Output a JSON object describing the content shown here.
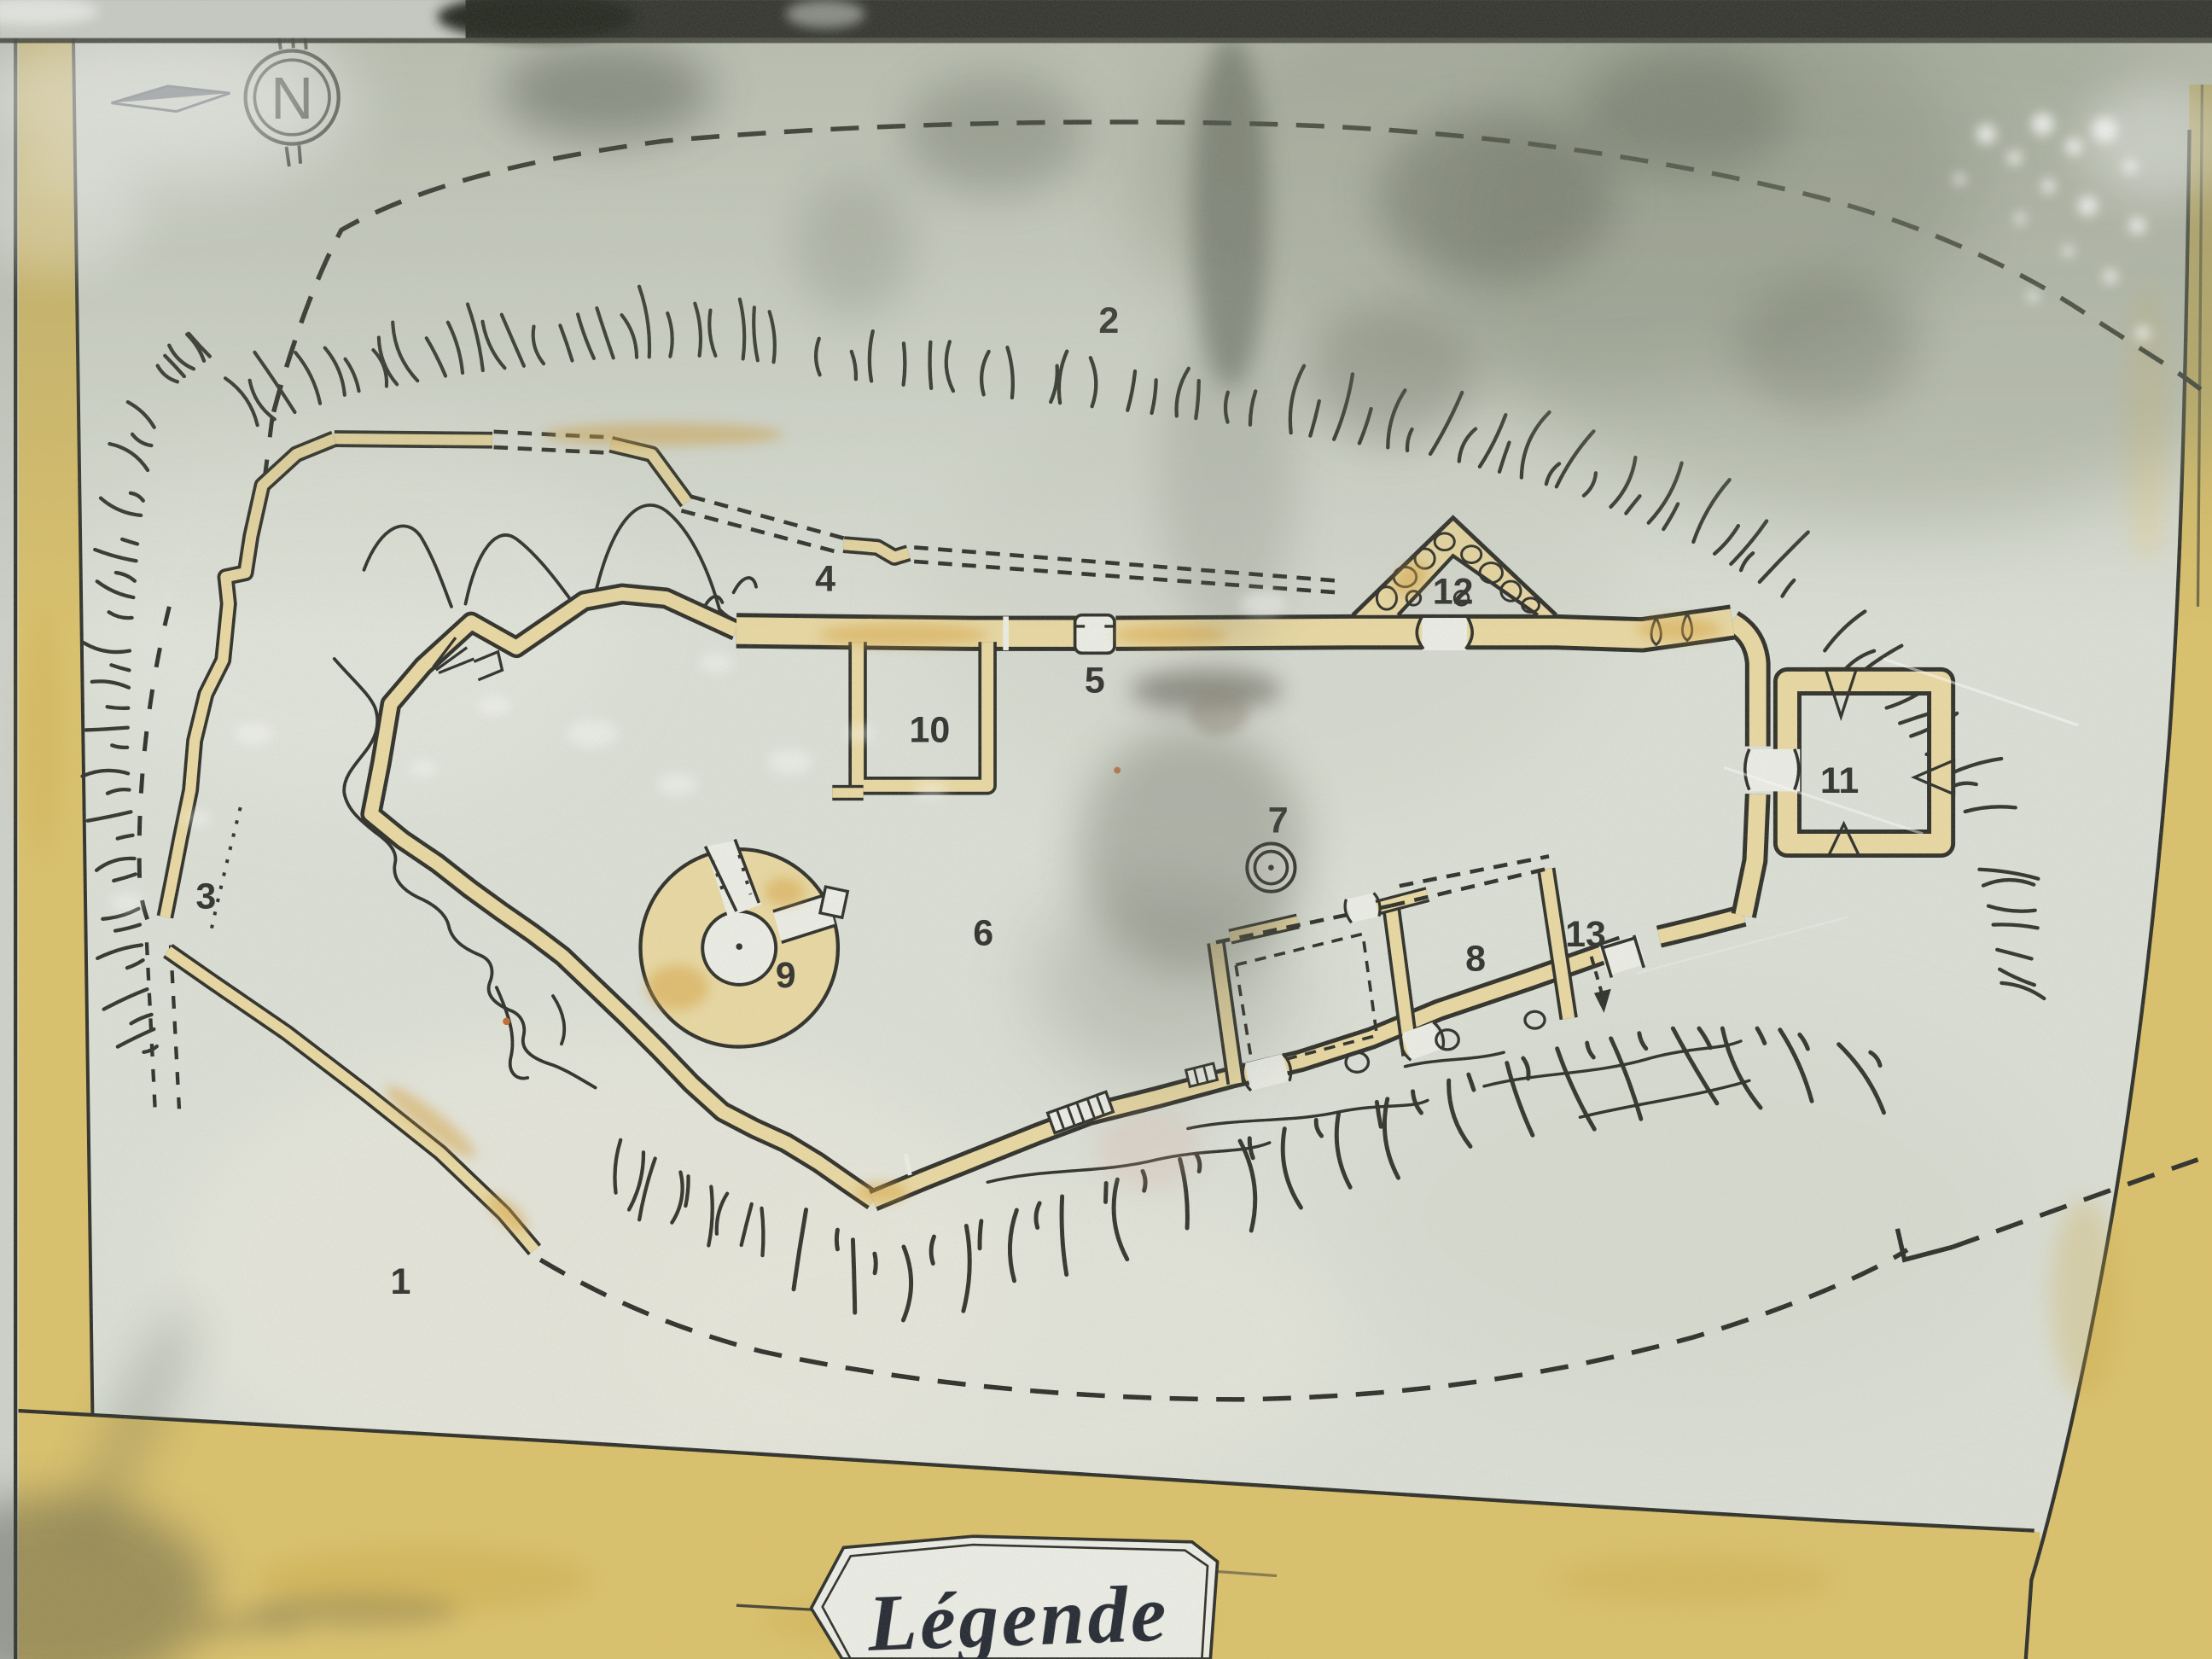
{
  "compass": {
    "label": "N"
  },
  "legend": {
    "title": "Légende"
  },
  "site_labels": [
    {
      "text": "1"
    },
    {
      "text": "2"
    },
    {
      "text": "3"
    },
    {
      "text": "4"
    },
    {
      "text": "5"
    },
    {
      "text": "6"
    },
    {
      "text": "7"
    },
    {
      "text": "8"
    },
    {
      "text": "9"
    },
    {
      "text": "10"
    },
    {
      "text": "11"
    },
    {
      "text": "12"
    },
    {
      "text": "13"
    }
  ],
  "colors": {
    "paper": "#dce0d6",
    "paper_light": "#ebe9de",
    "border_yellow": "#dcc26a",
    "border_deep": "#cda943",
    "wall_yellow": "#ead9a2",
    "wall_stain": "#d8a33e",
    "ink": "#2c2d27",
    "hatch_ink": "#30322a",
    "label_ink": "#2f2f2b",
    "white_room": "#edefe7",
    "legend_text": "#232730",
    "reflection_green": "#768066",
    "frame_dark": "#31332c"
  }
}
